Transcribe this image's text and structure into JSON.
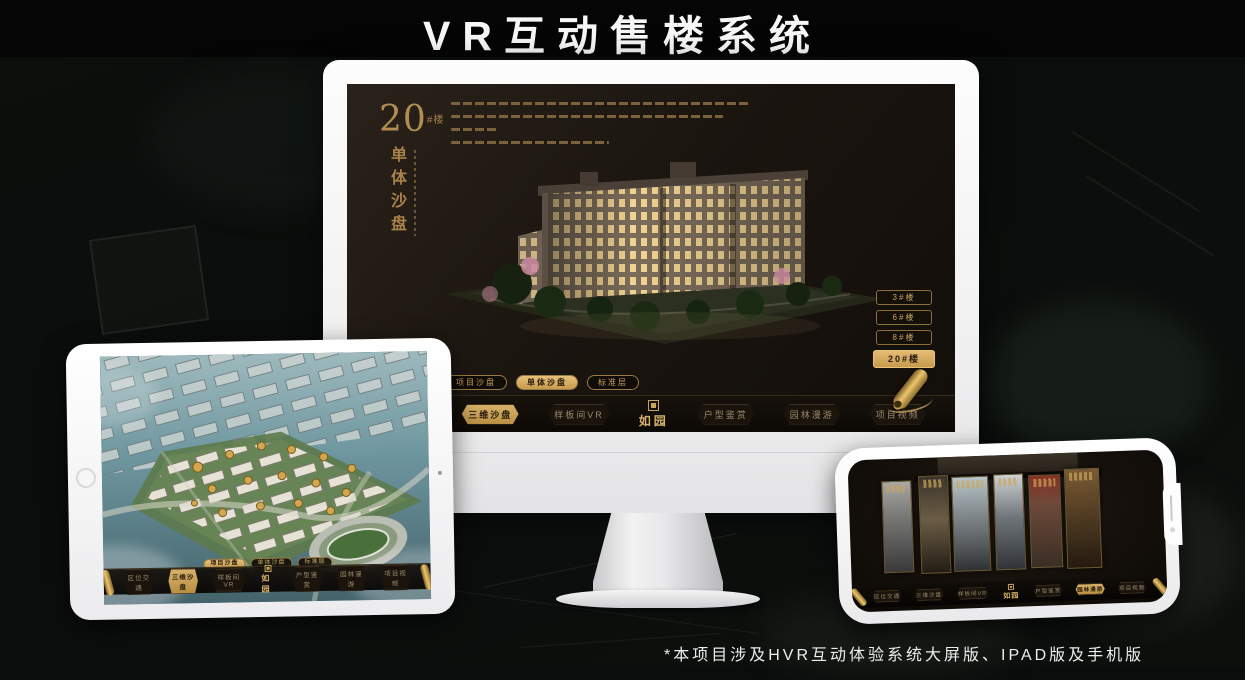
{
  "page": {
    "title": "VR互动售楼系统",
    "footnote": "*本项目涉及HVR互动体验系统大屏版、IPAD版及手机版"
  },
  "colors": {
    "accent_gold": "#c9a35f",
    "active_gold": "#d8b26a",
    "screen_dark": "#1b1510",
    "title_white": "#f7f7f7"
  },
  "monitor": {
    "heading": {
      "number": "20",
      "unit": "#楼",
      "subtitle": "单体沙盘"
    },
    "floor_buttons": [
      {
        "label": "3#楼",
        "active": false
      },
      {
        "label": "6#楼",
        "active": false
      },
      {
        "label": "8#楼",
        "active": false
      },
      {
        "label": "20#楼",
        "active": true
      }
    ],
    "view_tabs": [
      {
        "label": "项目沙盘",
        "active": false
      },
      {
        "label": "单体沙盘",
        "active": true
      },
      {
        "label": "标准层",
        "active": false
      }
    ],
    "nav": [
      {
        "label": "区位交通",
        "active": false
      },
      {
        "label": "三维沙盘",
        "active": true
      },
      {
        "label": "样板间VR",
        "active": false
      },
      {
        "label": "户型鉴赏",
        "active": false
      },
      {
        "label": "园林漫游",
        "active": false
      },
      {
        "label": "项目视频",
        "active": false
      }
    ],
    "logo": "如园"
  },
  "tablet": {
    "view_tabs": [
      {
        "label": "项目沙盘",
        "active": true
      },
      {
        "label": "单体沙盘",
        "active": false
      },
      {
        "label": "标准层",
        "active": false
      }
    ],
    "nav": [
      {
        "label": "区位交通",
        "active": false
      },
      {
        "label": "三维沙盘",
        "active": true
      },
      {
        "label": "样板间VR",
        "active": false
      },
      {
        "label": "户型鉴赏",
        "active": false
      },
      {
        "label": "园林漫游",
        "active": false
      },
      {
        "label": "项目视频",
        "active": false
      }
    ],
    "logo": "如园"
  },
  "phone": {
    "nav": [
      {
        "label": "区位交通",
        "active": false
      },
      {
        "label": "三维沙盘",
        "active": false
      },
      {
        "label": "样板间VR",
        "active": false
      },
      {
        "label": "户型鉴赏",
        "active": false
      },
      {
        "label": "园林漫游",
        "active": true
      },
      {
        "label": "项目视频",
        "active": false
      }
    ],
    "logo": "如园"
  }
}
